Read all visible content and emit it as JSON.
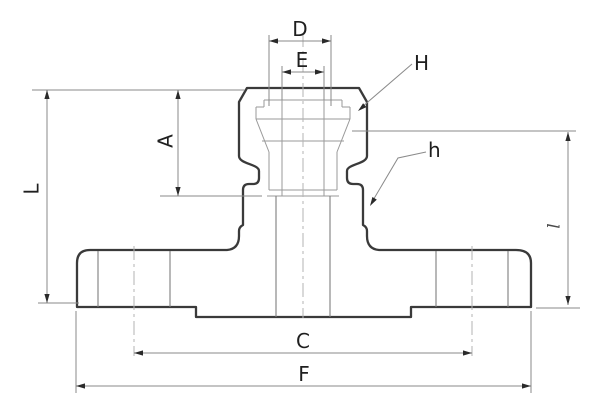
{
  "drawing": {
    "kind": "engineering-cross-section",
    "part": "flanged compression fitting",
    "dimension_labels": {
      "D": "D",
      "E": "E",
      "A": "A",
      "L": "L",
      "C": "C",
      "F": "F",
      "l": "l"
    },
    "callout_labels": {
      "H": "H",
      "h": "h"
    },
    "colors": {
      "outline": "#3a3a3a",
      "thin_line": "#9a9a9a",
      "dimension_line": "#8a8a8a",
      "centerline": "#b3b3b3",
      "text": "#1f1f1f",
      "background": "#ffffff"
    }
  }
}
